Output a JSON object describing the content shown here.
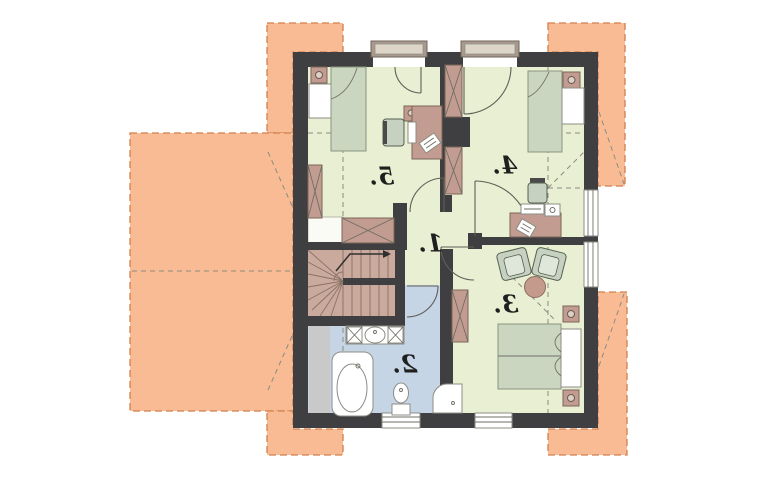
{
  "plan": {
    "kind": "upper-floor architectural plan",
    "labels_mirrored": true,
    "rooms": {
      "r1": {
        "label": "1."
      },
      "r2": {
        "label": "2."
      },
      "r3": {
        "label": "3."
      },
      "r4": {
        "label": "4."
      },
      "r5": {
        "label": "5."
      }
    },
    "symbols": [
      "roof-overhang",
      "exterior-wall",
      "interior-wall",
      "window",
      "dormer-window",
      "door-swing",
      "stairs",
      "stairs-direction-arrow",
      "wardrobe",
      "nightstand-with-lamp",
      "single-bed",
      "double-bed",
      "desk",
      "desk-chair",
      "armchair",
      "round-table",
      "bathtub",
      "shower",
      "toilet",
      "washbasin-counter",
      "knee-wall-dashed-line",
      "roof-ridge-dashed-line"
    ]
  },
  "colors": {
    "background": "#ffffff",
    "roof_overhang": "#f8bb94",
    "roof_overhang_border": "#d0804f",
    "wall": "#3f3f41",
    "room_floor": "#e9efd2",
    "bathroom_floor": "#c5d5e5",
    "stairs": "#c9aa9d",
    "furniture_wood": "#c29c90",
    "mattress": "#cbd6c1",
    "upholstery": "#c6d1c1",
    "fixture_white": "#ffffff",
    "low_headroom_gray": "#c9c9c9",
    "construction_line": "#8b8b80",
    "label_text": "#1f1f1f"
  }
}
